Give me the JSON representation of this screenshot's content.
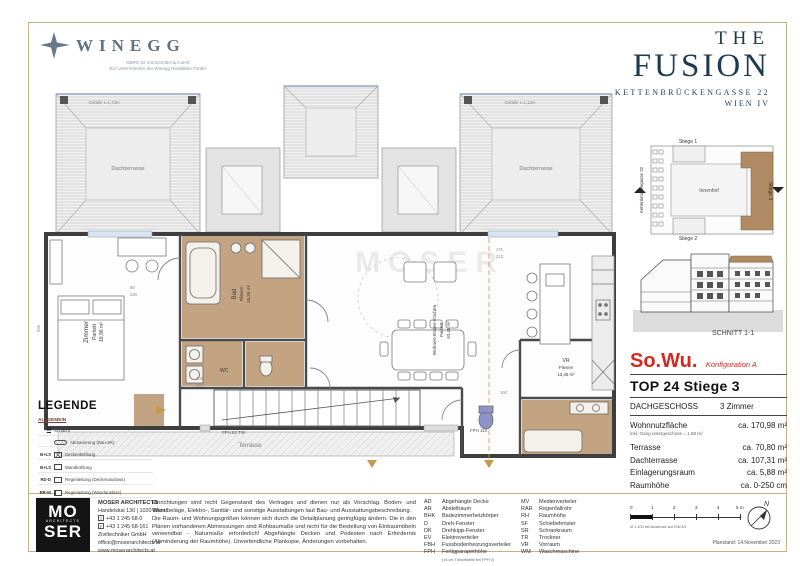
{
  "header": {
    "winegg": {
      "name": "WINEGG",
      "sub1": "KBRG 22 ImmoGmbH & CoKG",
      "sub2": "Ein Unternehmen der Winegg Realitäten GmbH"
    },
    "project": {
      "line1": "THE",
      "line2": "FUSION",
      "address": "KETTENBRÜCKENGASSE 22",
      "city": "WIEN IV"
    }
  },
  "siteplan": {
    "stiege1": "Stiege 1",
    "stiege2": "Stiege 2",
    "stiege3": "Stiege 3",
    "street": "Kettenbrückengasse 22",
    "courtyard": "Innenhof",
    "floor_tag": "DG"
  },
  "section": {
    "label": "SCHNITT 1-1"
  },
  "unit": {
    "type": "So.Wu.",
    "config": "Konfiguration A",
    "top": "TOP 24  Stiege 3",
    "floor": "DACHGESCHOSS",
    "rooms": "3 Zimmer",
    "rows": [
      {
        "l": "Wohnnutzfläche",
        "v": "ca. 170,98 m²",
        "n": "inkl. Gang untergeschoss = 1,98 m²"
      },
      {
        "l": "Terrasse",
        "v": "ca. 70,80 m²"
      },
      {
        "l": "Dachterrasse",
        "v": "ca. 107,31 m²"
      },
      {
        "l": "Einlagerungsraum",
        "v": "ca. 5,88 m²"
      },
      {
        "l": "Raumhöhe",
        "v": "ca. 0-250 cm"
      }
    ]
  },
  "legend": {
    "title": "LEGENDE",
    "subtitle": "ALLGEMEIN",
    "items": [
      {
        "a": "M",
        "t": "Schacht"
      },
      {
        "a": "",
        "t": "Abmauerung (Bau-SK)"
      },
      {
        "a": "B+LS",
        "t": "Deckenkühlung"
      },
      {
        "a": "B+LS",
        "t": "Wandkühlung"
      },
      {
        "a": "RD-D",
        "t": "Regenleitung (Deckenauslass)"
      },
      {
        "a": "RR-W",
        "t": "Regenleitung (Wandauslass)"
      }
    ]
  },
  "plan": {
    "watermark": "MOSER",
    "labels": [
      {
        "t": "Zimmer"
      },
      {
        "t": "Parkett"
      },
      {
        "t": "18,96 m²"
      },
      {
        "t": "Bad"
      },
      {
        "t": "Fliesen"
      },
      {
        "t": "16,35 m²"
      },
      {
        "t": "WC"
      },
      {
        "t": "Wohnen-Essen-Kochen"
      },
      {
        "t": "Parkett"
      },
      {
        "t": "63,45 m²"
      },
      {
        "t": "VR"
      },
      {
        "t": "Fliesen"
      },
      {
        "t": "13,45 m²"
      },
      {
        "t": "Terrasse"
      },
      {
        "t": "Dachterrasse"
      },
      {
        "t": "Dachterrasse"
      },
      {
        "t": "Gefälle t=1,72m"
      },
      {
        "t": "Gefälle t=1,12m"
      },
      {
        "t": "FPH 83 TW"
      },
      {
        "t": "FPH 114"
      }
    ],
    "dims": [
      "104",
      "525",
      "88",
      "230",
      "171",
      "213",
      "595",
      "150"
    ]
  },
  "footer": {
    "architect": {
      "logo1": "MO",
      "logo2": "ARCHITECTS",
      "logo3": "SER",
      "name": "MOSER ARCHITECTS",
      "address": "Handelskai 130 | 1020 Wien",
      "tel": "+43 1 245 68-0",
      "fax": "+43 1 245 68-161",
      "company": "Ziviltechniker GmbH",
      "email": "office@moserarchitects.at",
      "web": "www.moserarchitects.at"
    },
    "disclaimer1": "Einrichtungen sind nicht Gegenstand des Vertrages und dienen nur als Vorschlag. Boden- und Wandbeläge, Elektro-, Sanitär- und sonstige Ausstattungen laut Bau- und Ausstattungsbeschreibung.",
    "disclaimer2": "Die Raum- und Wohnungsgrößen können sich durch die Detailplanung geringfügig ändern. Die in den Plänen vorhandenen Abmessungen sind Rohbaumaße und nicht für die Bestellung von Einbaumöbeln verwendbar - Naturmaße erforderlich! Abgehängte Decken und Podesten nach Erfordernis (Abminderung der Raumhöhe). Unverbindliche Plankopie, Änderungen vorbehalten.",
    "abbrev_left": [
      [
        "AD",
        "Abgehängte Decke"
      ],
      [
        "AR",
        "Abstellraum"
      ],
      [
        "BHK",
        "Badezimmerheizkörper"
      ],
      [
        "D",
        "Dreh-Fenster"
      ],
      [
        "DK",
        "Drehkipp-Fenster"
      ],
      [
        "EV",
        "Elektroverteiler"
      ],
      [
        "FBH",
        "Fussbodenheizungsverteiler"
      ],
      [
        "FPH",
        "Fertigparapethöhe"
      ]
    ],
    "fph_note": "(±5 cm Türschwelle bei FPH 0)",
    "abbrev_right": [
      [
        "MV",
        "Medienverteiler"
      ],
      [
        "RAR",
        "Regenfallrohr"
      ],
      [
        "RH",
        "Raumhöhe"
      ],
      [
        "SF",
        "Schiebefenster"
      ],
      [
        "SR",
        "Schrankraum"
      ],
      [
        "TR",
        "Trockner"
      ],
      [
        "VR",
        "Vorraum"
      ],
      [
        "WM",
        "Waschmaschine"
      ]
    ],
    "scale": {
      "ticks": [
        "0",
        "1",
        "2",
        "3",
        "4",
        "5 m"
      ],
      "note": "M 1:100 bei Ausdruck auf DIN A4"
    },
    "plan_date": "Planstand: 14.November 2023"
  }
}
